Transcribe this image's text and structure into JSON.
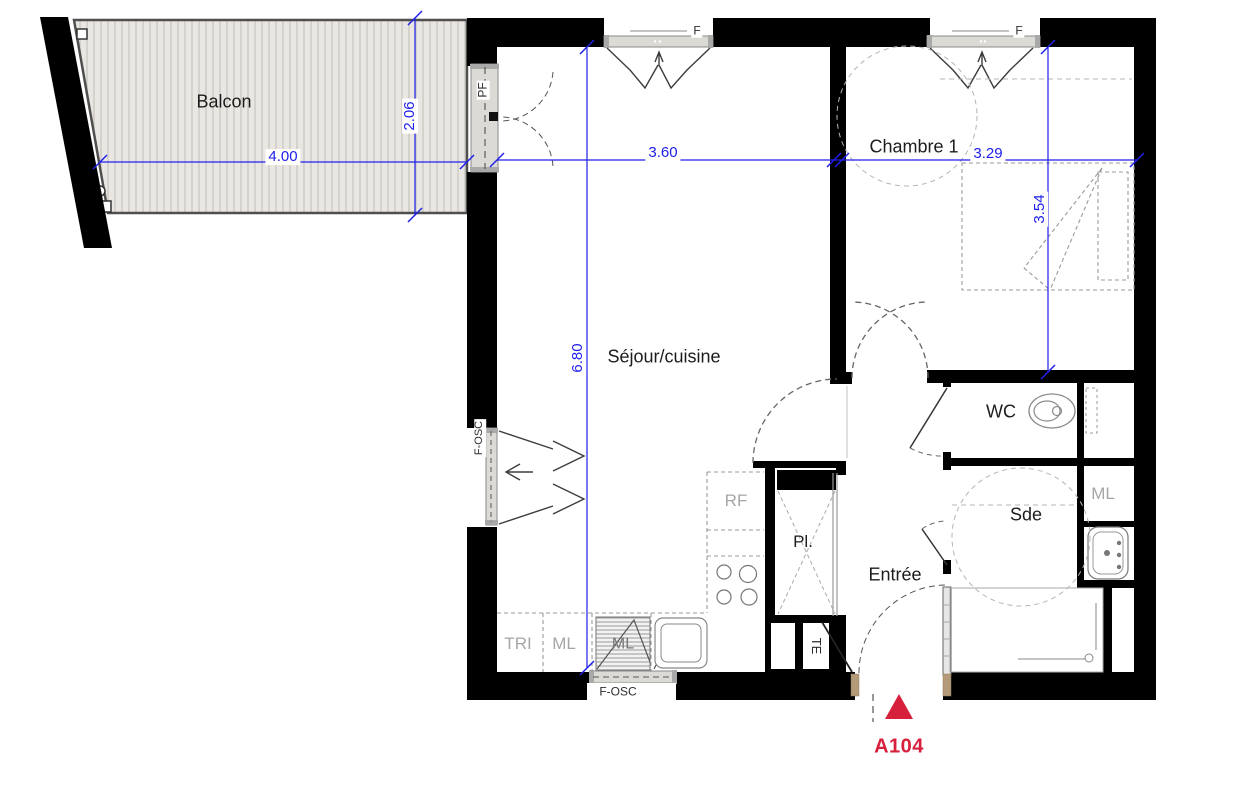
{
  "unit": {
    "code": "A104"
  },
  "rooms": {
    "balcon": "Balcon",
    "sejour": "Séjour/cuisine",
    "chambre": "Chambre 1",
    "wc": "WC",
    "sde": "Sde",
    "entree": "Entrée"
  },
  "dims": {
    "balcon_width": "4.00",
    "balcon_depth": "2.06",
    "sejour_width": "3.60",
    "chambre_width": "3.29",
    "chambre_depth": "3.54",
    "sejour_depth": "6.80"
  },
  "openings": {
    "pf": "PF",
    "f": "F",
    "f_osc": "F-OSC"
  },
  "equipment": {
    "rf": "RF",
    "tri": "TRI",
    "ml": "ML",
    "pl": "Pl.",
    "te": "TE"
  },
  "colors": {
    "dimension_blue": "#2020ea",
    "wall_black": "#000000",
    "accent_red": "#d6203c",
    "muted_gray": "#a6a6a6",
    "deck_fill": "#eae7e3",
    "deck_stripe": "#c9c6c0",
    "window_fill": "#dcdad5",
    "threshold_tan": "#b49a78"
  }
}
